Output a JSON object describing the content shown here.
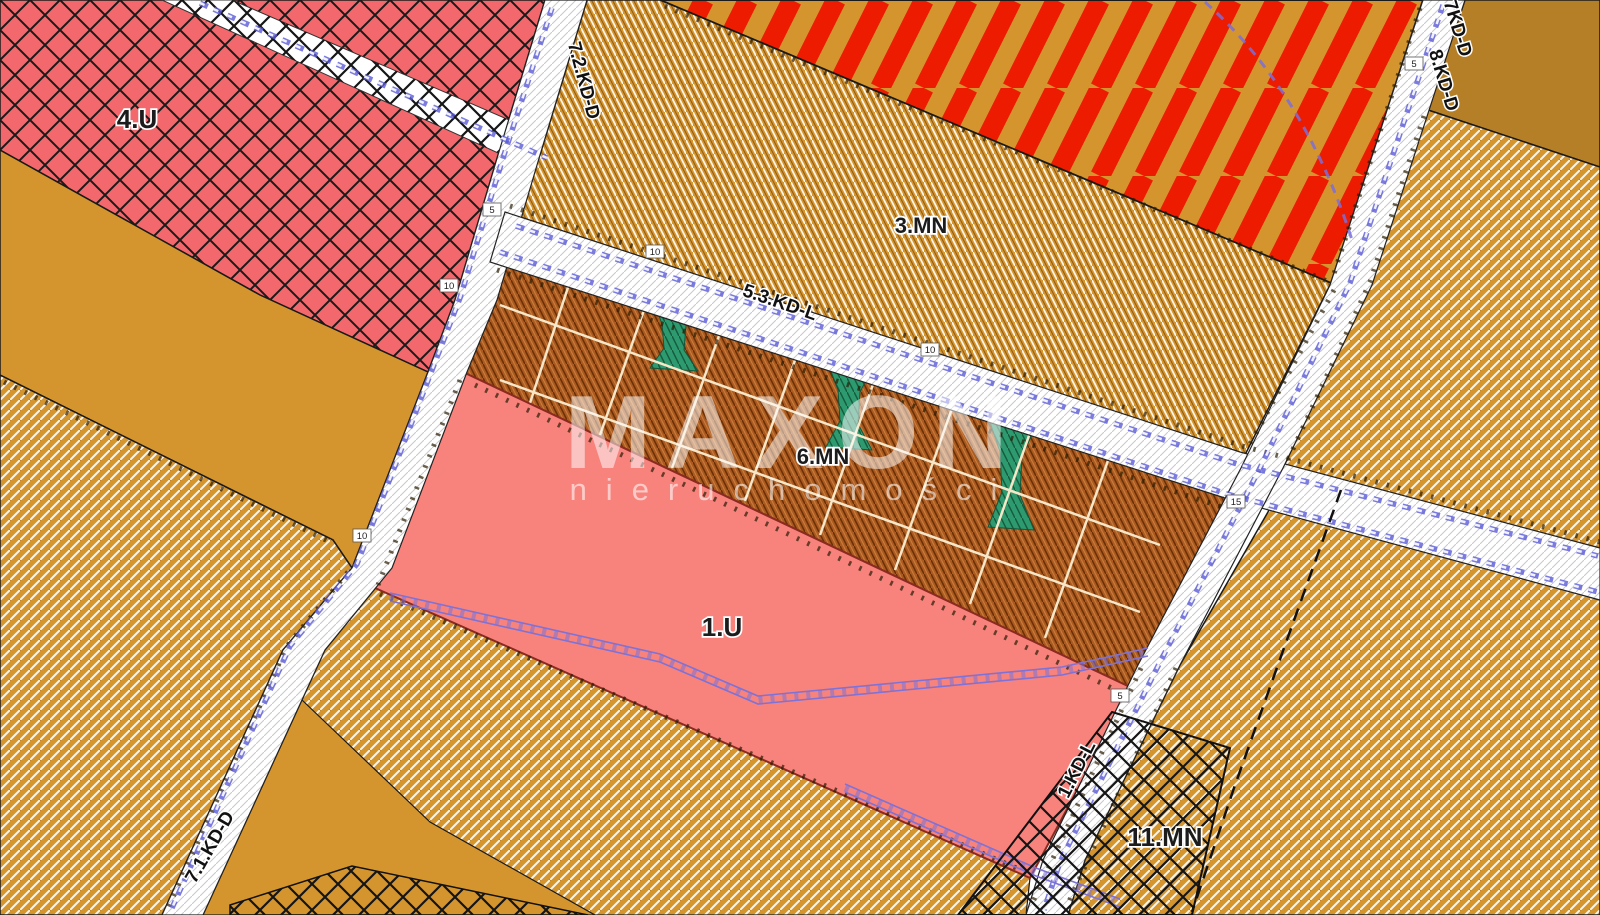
{
  "zones": {
    "u4": "4.U",
    "mn3": "3.MN",
    "mn6": "6.MN",
    "u1": "1.U",
    "mn11": "11.MN"
  },
  "roads": {
    "kdd72": "7.2.KD-D",
    "kdl53": "5.3.KD-L",
    "kdd7": "7KD-D",
    "kdd8": "8.KD-D",
    "kdl1": "1.KD-L",
    "kdd71": "7.1.KD-D"
  },
  "dims": [
    "10",
    "5",
    "10",
    "15",
    "5",
    "5",
    "10",
    "10"
  ],
  "watermark": {
    "brand": "MAXON",
    "subtitle": "nieruchomości"
  },
  "colors": {
    "zone_4u_pink": "#F2686C",
    "zone_1u_pink": "#F8837D",
    "tan_base": "#D4952F",
    "brown_parcel": "#AC5A20",
    "green_strip": "#2E9A6F",
    "red_stripe": "#ED1C00",
    "road_white": "#FFFFFF",
    "dash_blue": "#5B5BD6",
    "chain_violet": "#7E72D6"
  }
}
